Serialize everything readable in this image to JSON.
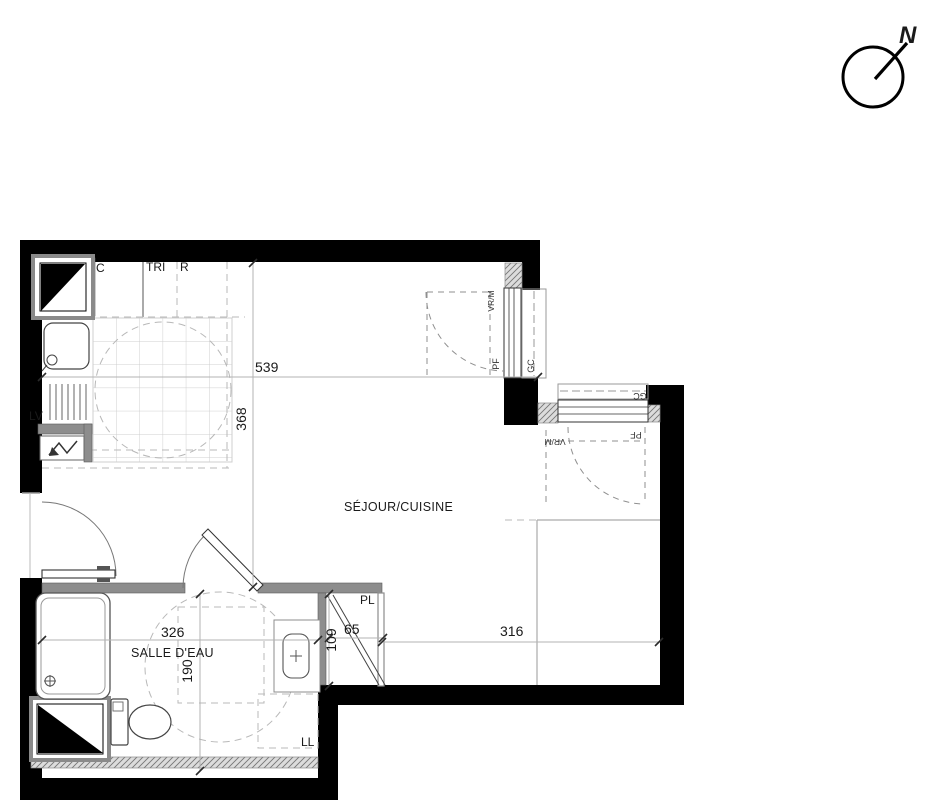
{
  "compass": {
    "north_label": "N"
  },
  "rooms": {
    "living_kitchen": "SÉJOUR/CUISINE",
    "bathroom": "SALLE D'EAU"
  },
  "dimensions": {
    "living_width": "539",
    "living_depth": "368",
    "bathroom_width": "326",
    "bathroom_depth": "190",
    "closet_depth": "109",
    "closet_width": "65",
    "living_right_width": "316"
  },
  "fixtures": {
    "cupboard": "C",
    "sorting": "TRI",
    "fridge": "R",
    "dishwasher": "LV",
    "washing_machine": "LL",
    "closet": "PL"
  },
  "windows": {
    "window_right": {
      "type": "PF",
      "railing": "GC",
      "shutter": "VR/M"
    },
    "window_top": {
      "type": "PF",
      "railing": "GC",
      "shutter": "VR/M"
    }
  }
}
